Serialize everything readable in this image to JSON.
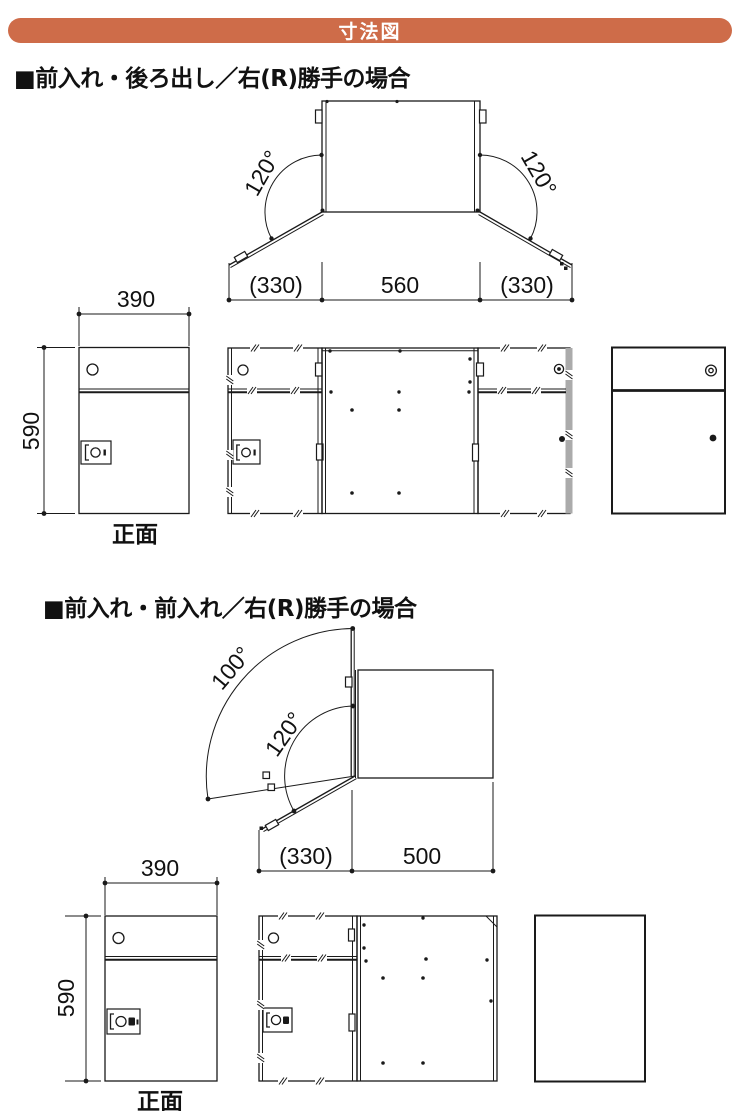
{
  "header": {
    "title": "寸法図",
    "bg_color": "#CE6C49",
    "text_color": "#FFFFFF"
  },
  "line_color": "#1A1A1A",
  "sections": [
    {
      "title": "■前入れ・後ろ出し／右(R)勝手の場合",
      "top_view": {
        "angle_left": "120°",
        "angle_right": "120°",
        "dim_left": "(330)",
        "dim_center": "560",
        "dim_right": "(330)"
      },
      "front_view": {
        "width": "390",
        "height": "590",
        "caption": "正面"
      }
    },
    {
      "title": "■前入れ・前入れ／右(R)勝手の場合",
      "top_view": {
        "angle_outer": "100°",
        "angle_inner": "120°",
        "dim_left": "(330)",
        "dim_right": "500"
      },
      "front_view": {
        "width": "390",
        "height": "590",
        "caption": "正面"
      }
    }
  ]
}
